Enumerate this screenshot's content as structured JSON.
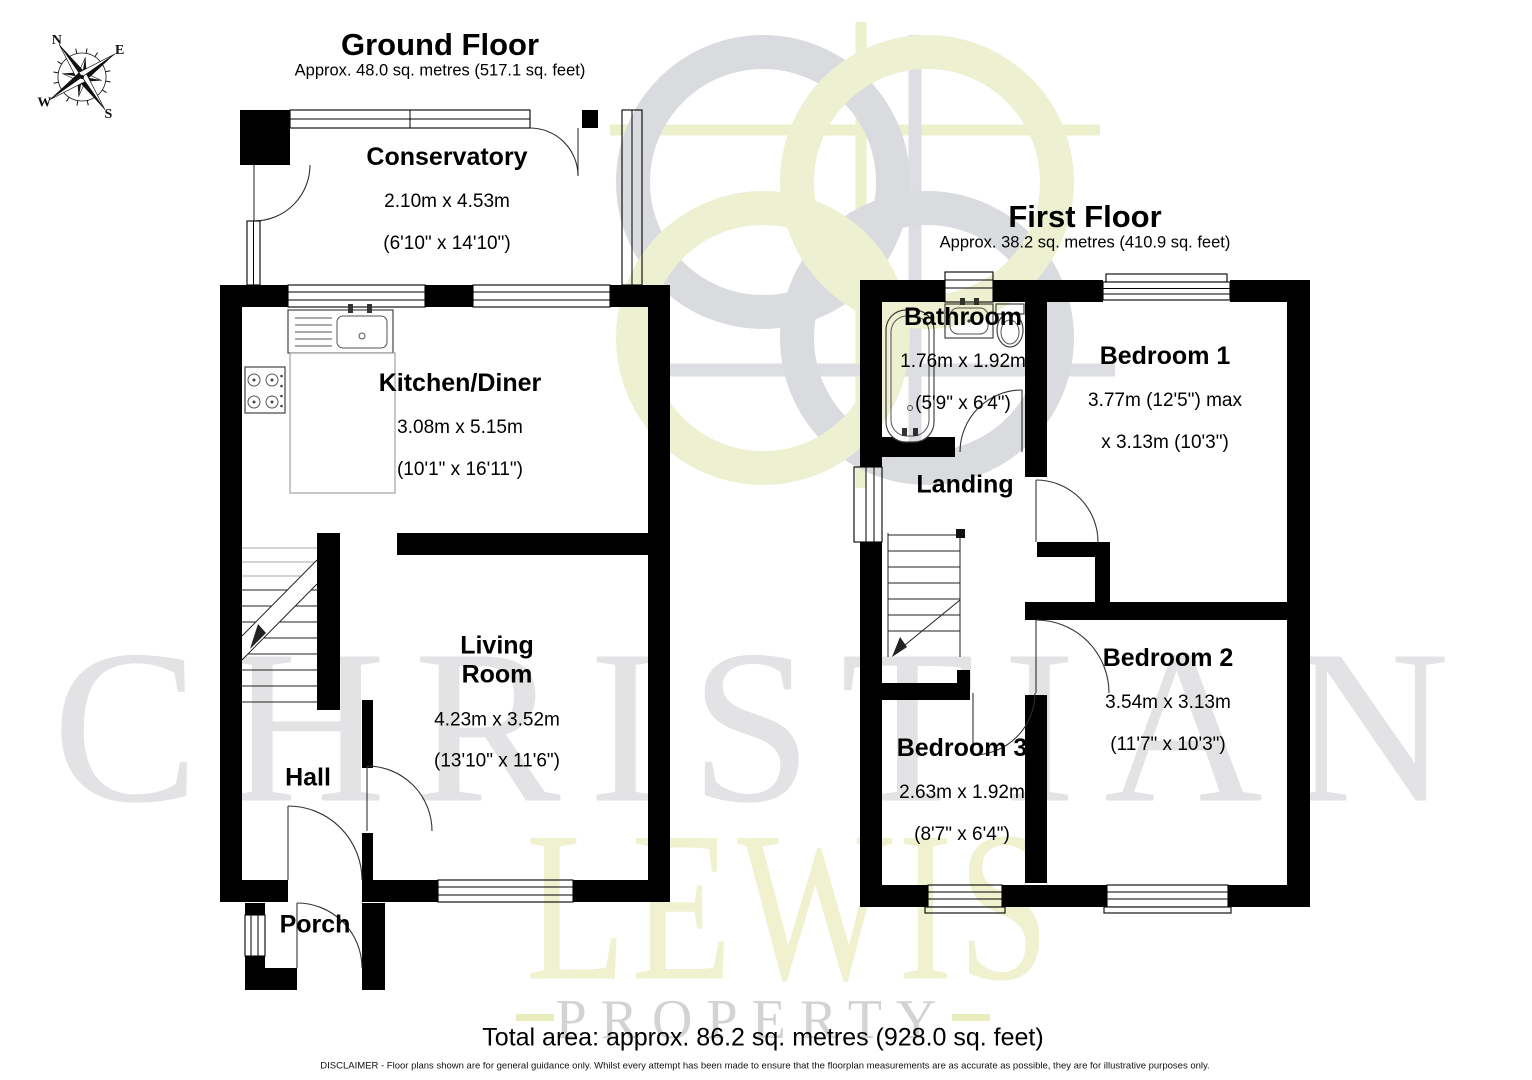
{
  "ground_floor": {
    "title": "Ground Floor",
    "subtitle": "Approx. 48.0 sq. metres (517.1 sq. feet)",
    "rooms": {
      "conservatory": {
        "name": "Conservatory",
        "dims_m": "2.10m x 4.53m",
        "dims_ft": "(6'10\" x 14'10\")"
      },
      "kitchen": {
        "name": "Kitchen/Diner",
        "dims_m": "3.08m x 5.15m",
        "dims_ft": "(10'1\" x 16'11\")"
      },
      "living": {
        "name": "Living\nRoom",
        "dims_m": "4.23m x 3.52m",
        "dims_ft": "(13'10\" x 11'6\")"
      },
      "hall": {
        "name": "Hall"
      },
      "porch": {
        "name": "Porch"
      }
    }
  },
  "first_floor": {
    "title": "First Floor",
    "subtitle": "Approx. 38.2 sq. metres (410.9 sq. feet)",
    "rooms": {
      "bathroom": {
        "name": "Bathroom",
        "dims_m": "1.76m x 1.92m",
        "dims_ft": "(5'9\" x 6'4\")"
      },
      "bedroom1": {
        "name": "Bedroom 1",
        "dims_m": "3.77m (12'5\") max",
        "dims_ft": "x 3.13m (10'3\")"
      },
      "landing": {
        "name": "Landing"
      },
      "bedroom2": {
        "name": "Bedroom 2",
        "dims_m": "3.54m x 3.13m",
        "dims_ft": "(11'7\" x 10'3\")"
      },
      "bedroom3": {
        "name": "Bedroom 3",
        "dims_m": "2.63m x 1.92m",
        "dims_ft": "(8'7\" x 6'4\")"
      }
    }
  },
  "compass": {
    "n": "N",
    "e": "E",
    "s": "S",
    "w": "W"
  },
  "watermark": {
    "line1": "CHRISTIAN",
    "line2": "LEWIS",
    "line3": "PROPERTY"
  },
  "footer": {
    "total_area": "Total area: approx. 86.2 sq. metres (928.0 sq. feet)",
    "disclaimer": "DISCLAIMER - Floor plans shown are for general guidance only. Whilst every attempt has been made to ensure that the floorplan measurements are as accurate as possible, they are for illustrative purposes only."
  },
  "colors": {
    "wall": "#000000",
    "watermark_grey": "#e3e3e6",
    "watermark_yellow": "#eff1cf",
    "watermark_property_grey": "#d3d3d6",
    "emblem_grey": "#d9dbde",
    "emblem_yellow": "#eef0d2"
  }
}
